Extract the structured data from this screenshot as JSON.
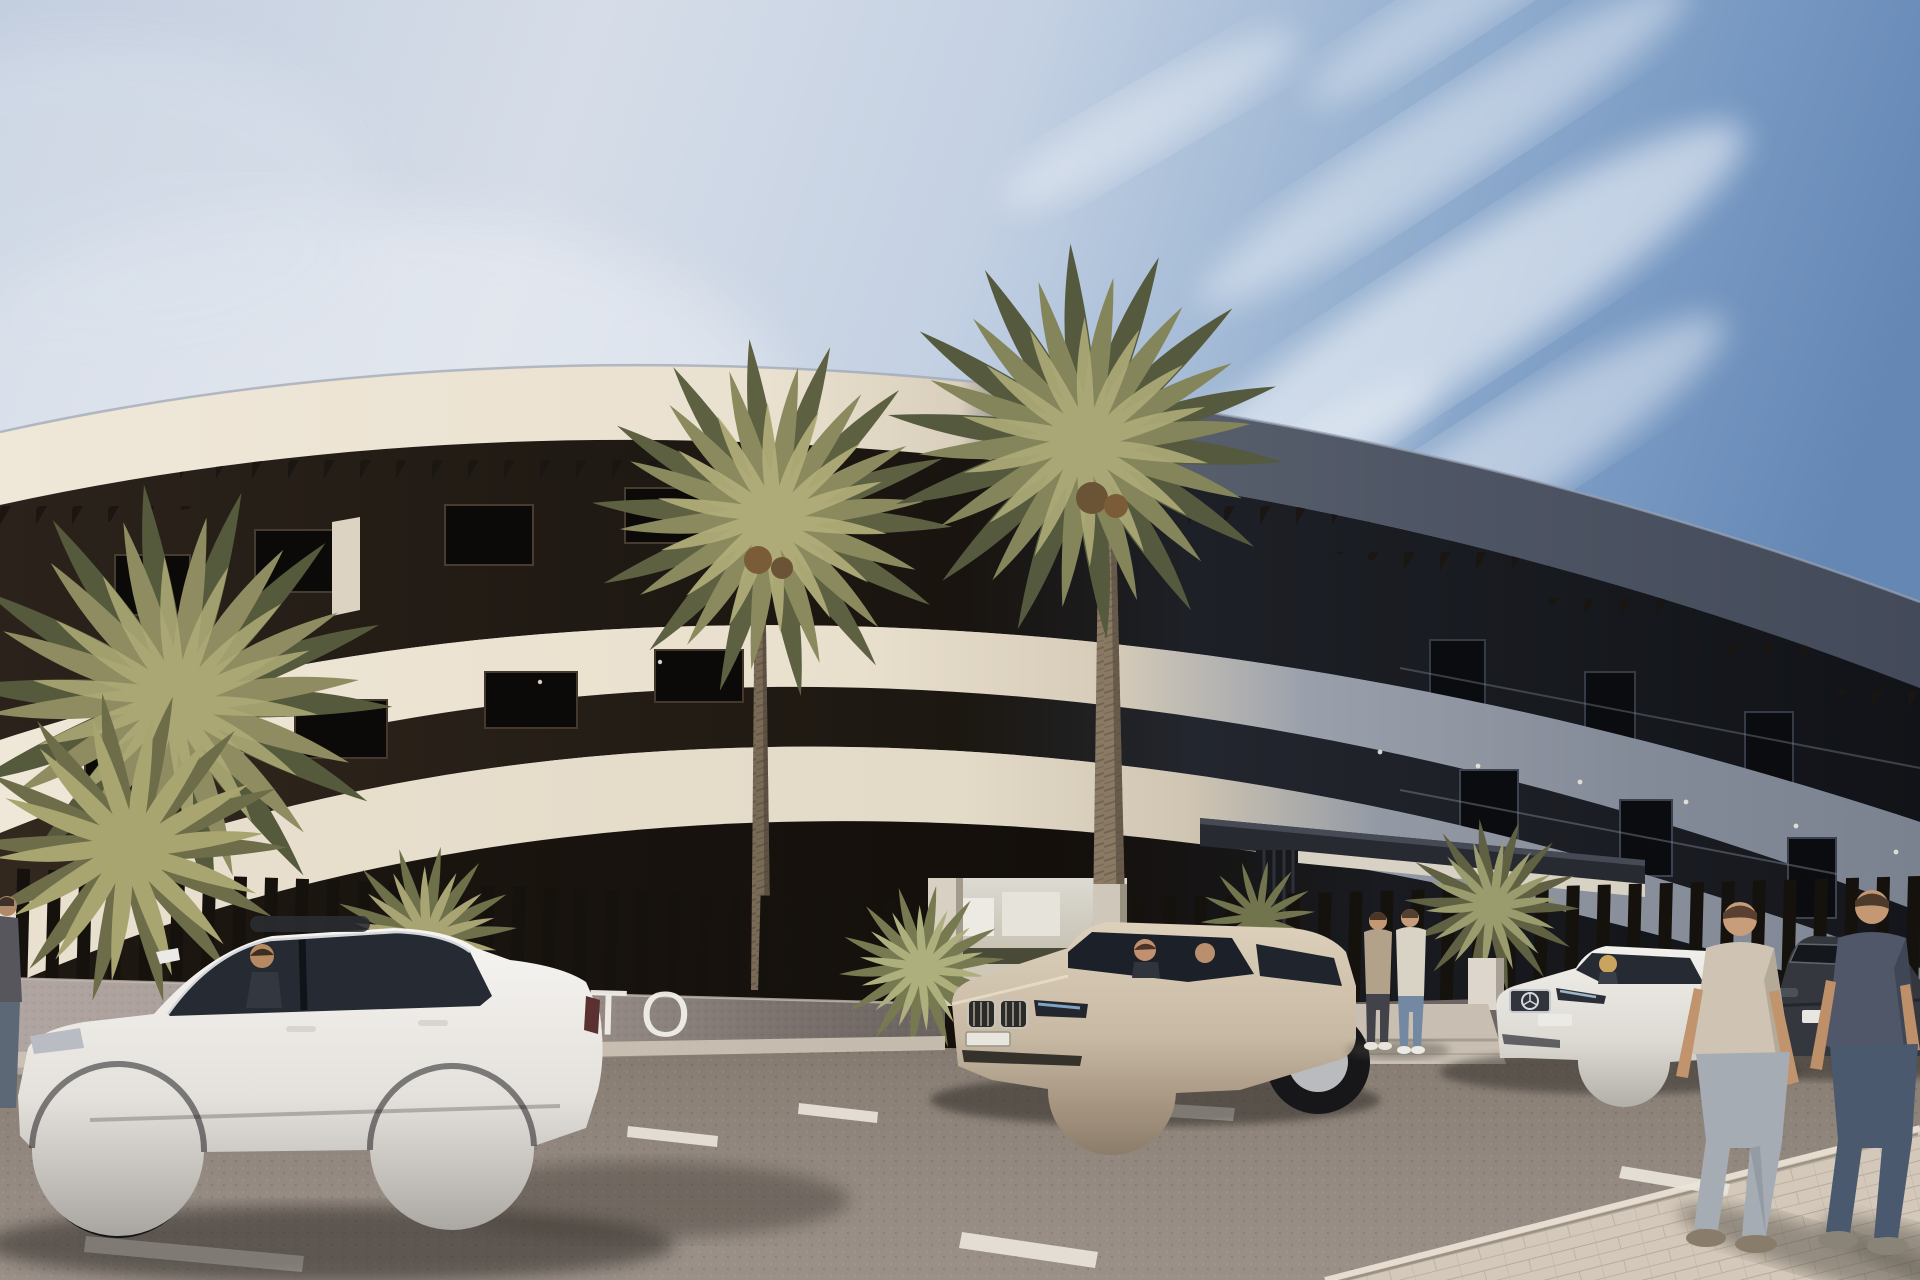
{
  "meta": {
    "kind": "architectural-render",
    "description": "Sunny 3D architectural rendering of a modern curved cream apartment building with black slat fence, date palms, parked cars and pedestrians",
    "width_px": 1920,
    "height_px": 1280
  },
  "signage": {
    "wall_letters": "TO",
    "letters_color": "#f2efe8"
  },
  "palette": {
    "sky_left": "#c6d1e2",
    "sky_right": "#6588b5",
    "cloud": "#ffffff",
    "facade_cream": "#ece3d2",
    "facade_shadow_gray": "#7e8592",
    "roof_dark": "#4a5160",
    "dark_floor": "#1a140f",
    "fence_dark": "#15120e",
    "wall_light": "#a89d98",
    "wall_shaded": "#6e6662",
    "road": "#8d8279",
    "curb": "#cdc3b6",
    "sidewalk": "#d3c8b9",
    "palm_olive": "#84855a",
    "palm_light": "#b0ac78",
    "trunk": "#7a6b57",
    "car_white": "#f0eeea",
    "car_champagne": "#c9bba6",
    "car_dark": "#34373d",
    "skin": "#c79d7a"
  },
  "scene": {
    "sky": {
      "label": "Blue sky with wispy diagonal cirrus clouds, deeper blue at upper right"
    },
    "building": {
      "label": "Curved white apartment building with three upper floors over a ground level",
      "floors_visible": 4,
      "bands": [
        {
          "label": "curved roof fascia, sunlit cream turning slate gray on right"
        },
        {
          "label": "top floor terrace with dark pergola slats"
        },
        {
          "label": "second balcony fascia band"
        },
        {
          "label": "middle floor with dark window openings"
        },
        {
          "label": "first balcony fascia band"
        },
        {
          "label": "dark ground floor behind perimeter fence"
        }
      ]
    },
    "entrance": {
      "label": "Main entrance with flat dark canopy, slatted pillar and light stone walkway",
      "canopy": "dark flat canopy slab",
      "walkway": "light stone walkway"
    },
    "fence": {
      "label": "Black vertical slat fence on a low speckled concrete wall with white gate piers"
    },
    "vegetation": {
      "label": "Date palms and desert shrubs",
      "tall_palms": 2,
      "left_palm_cluster": true,
      "entrance_yuccas": 2
    },
    "vehicles": [
      {
        "label": "White sedan parked in foreground, side view, driver inside",
        "color_name": "white"
      },
      {
        "label": "Champagne SUV facing viewer with two occupants",
        "color_name": "champagne"
      },
      {
        "label": "White saloon parked by the entrance, driver inside",
        "color_name": "white"
      },
      {
        "label": "Dark gray sedan parked at far right",
        "color_name": "dark gray"
      }
    ],
    "people": [
      {
        "label": "Partial pedestrian at extreme left edge"
      },
      {
        "label": "Two men talking on the entrance walkway"
      },
      {
        "label": "Two men walking away on the sidewalk, foreground right"
      }
    ],
    "road": {
      "label": "Asphalt street with white parking bay markings",
      "markings_count": 6
    },
    "sidewalk": {
      "label": "Pale paved sidewalk across the bottom right corner"
    }
  }
}
